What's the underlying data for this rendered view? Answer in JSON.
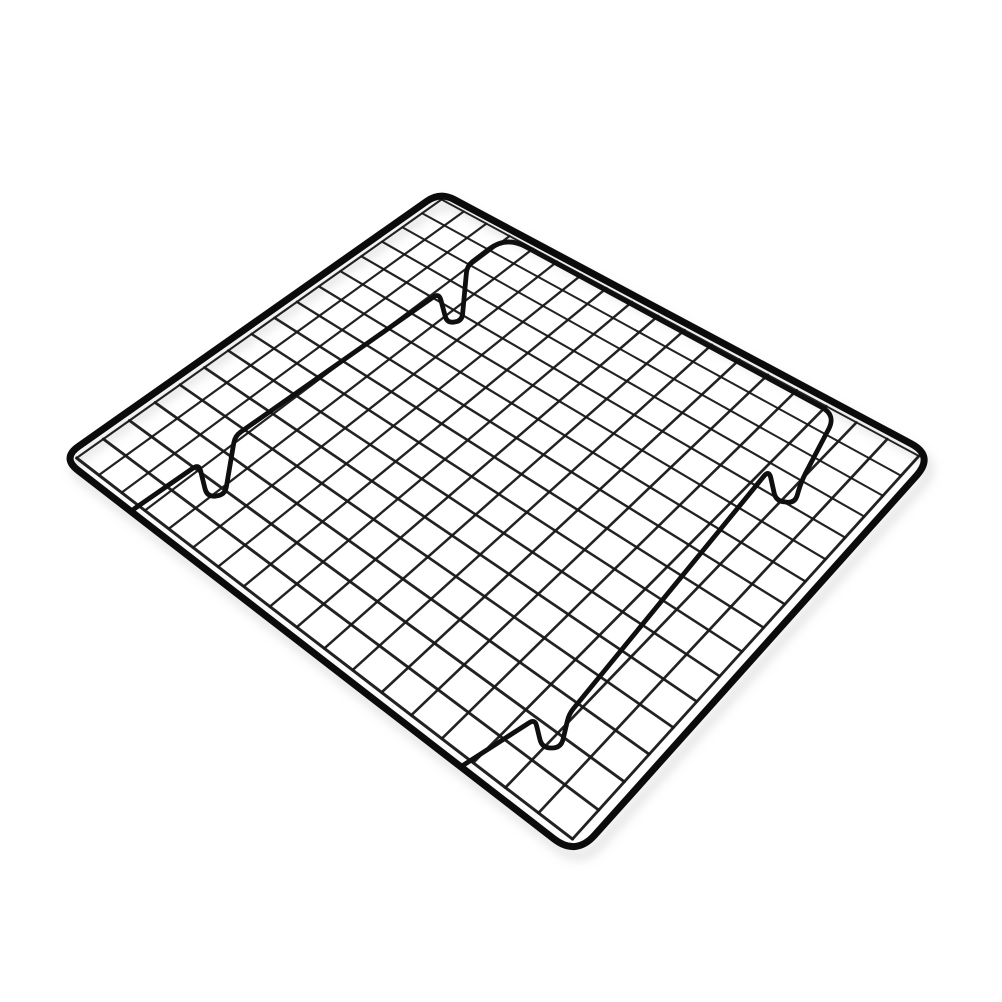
{
  "page": {
    "background_color": "#ffffff"
  },
  "product": {
    "name": "Black wire cooling rack",
    "description": "Black non-stick steel wire cooling rack with a square grid mesh, rounded outer frame and bent-wire fold-out feet, photographed at an angle on a plain white background.",
    "alt_text": "Black metal grid cooling rack standing on four bent wire feet, angled view on a white background",
    "wire_color": "#101010",
    "background_color": "#ffffff"
  },
  "figure": {
    "canvas": {
      "width": 1002,
      "height": 1002
    },
    "frame": {
      "corners": {
        "top": [
          440,
          192
        ],
        "right": [
          934,
          456
        ],
        "bottom": [
          576,
          856
        ],
        "left": [
          62,
          458
        ]
      },
      "corner_radii": [
        16,
        26,
        28,
        20
      ],
      "stroke_width": 7,
      "color": "#0b0b0b"
    },
    "mesh": {
      "cells_u": 18,
      "cells_v": 16,
      "inset": 0.017,
      "min_stroke": 1.9,
      "max_stroke": 3.0,
      "color": "#191919",
      "opacity": 0.96
    },
    "support_wire": {
      "stroke_width": 4.8,
      "color": "#0f0f0f",
      "points": [
        [
          134,
          509
        ],
        [
          199,
          464
        ],
        [
          207,
          497
        ],
        [
          225,
          495
        ],
        [
          235,
          436
        ],
        [
          439,
          293
        ],
        [
          447,
          323
        ],
        [
          462,
          321
        ],
        [
          467,
          266
        ],
        [
          506,
          236
        ],
        [
          836,
          415
        ],
        [
          801,
          482
        ],
        [
          795,
          503
        ],
        [
          776,
          501
        ],
        [
          769,
          470
        ],
        [
          569,
          714
        ],
        [
          561,
          748
        ],
        [
          542,
          748
        ],
        [
          535,
          719
        ],
        [
          462,
          766
        ]
      ],
      "radii": [
        0,
        7,
        9,
        9,
        7,
        7,
        9,
        9,
        7,
        22,
        16,
        10,
        8,
        8,
        8,
        7,
        9,
        9,
        7,
        0
      ]
    },
    "shadow": {
      "dx": 5,
      "dy": 9,
      "blur": 5,
      "color": "#9a9a9a",
      "opacity": 0.28,
      "stroke_width": 9
    }
  }
}
